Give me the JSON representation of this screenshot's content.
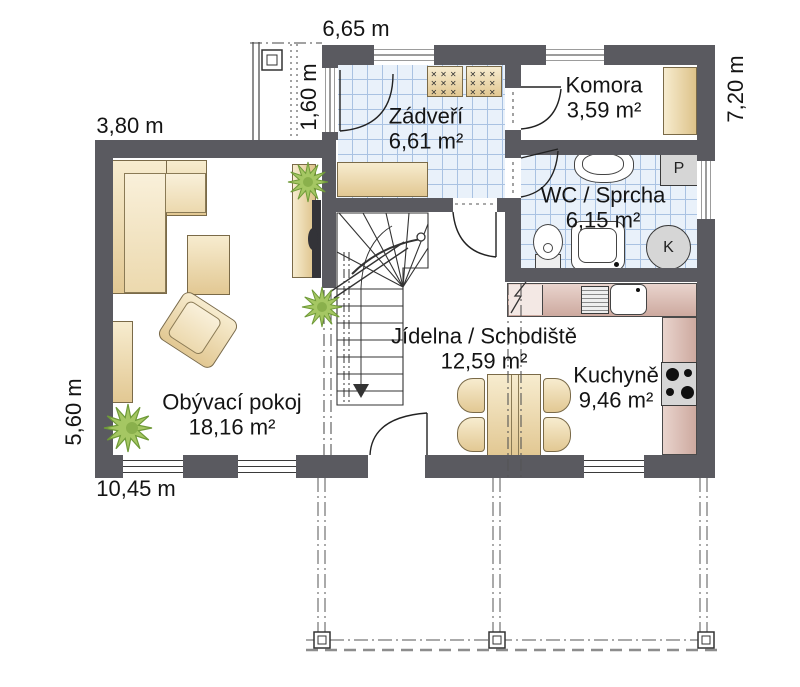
{
  "plan_type": "floor-plan",
  "rooms": [
    {
      "name": "Zádveří",
      "area": "6,61 m²"
    },
    {
      "name": "Komora",
      "area": "3,59 m²"
    },
    {
      "name": "WC / Sprcha",
      "area": "6,15 m²"
    },
    {
      "name": "Jídelna / Schodiště",
      "area": "12,59 m²"
    },
    {
      "name": "Kuchyně",
      "area": "9,46 m²"
    },
    {
      "name": "Obývací pokoj",
      "area": "18,16 m²"
    }
  ],
  "dimensions": {
    "top_width": "6,65 m",
    "upper_left_width": "3,80 m",
    "porch_depth": "1,60 m",
    "right_height": "7,20 m",
    "left_height": "5,60 m",
    "bottom_width": "10,45 m"
  },
  "appliances": {
    "washing_machine": "P",
    "boiler": "K"
  },
  "decor": {
    "shoe_rack_row": "✕✕✕"
  },
  "colors": {
    "wall": "#5a5a60",
    "tile_floor": "#e9f1fa",
    "wood_furniture": "#ecd9a8",
    "kitchen_counter": "#d9b9b1",
    "plant": "#a5c763"
  }
}
